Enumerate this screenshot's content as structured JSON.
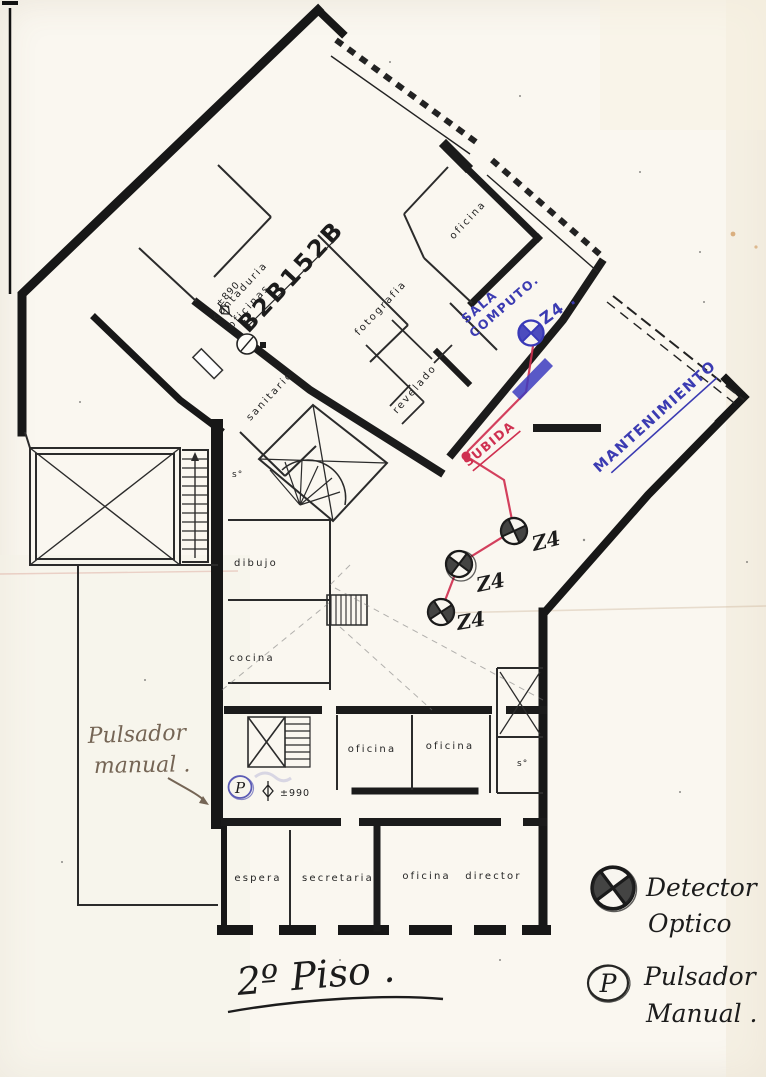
{
  "page": {
    "floor_title": "2º Piso .",
    "background_color": "#faf7f0"
  },
  "plan": {
    "drawing_number": "B2B152B",
    "room_labels": {
      "oficinas_contaduria_line1": "contaduria",
      "oficinas_contaduria_line2": "oficinas",
      "oficina_top": "oficina",
      "fotografia": "fotografia",
      "sanitario": "sanitario",
      "revelado": "revelado",
      "dibujo": "dibujo",
      "cocina": "cocina",
      "oficina_1": "oficina",
      "oficina_2": "oficina",
      "espera": "espera",
      "secretaria": "secretaria",
      "oficina_director": "oficina director",
      "servicio_1": "s°",
      "servicio_2": "s°"
    },
    "elevation_marker_top": "±890",
    "elevation_marker_bottom": "±990"
  },
  "annotations": {
    "ink_colors": {
      "blue": "#3b3bb2",
      "red": "#cf3050",
      "black": "#1c1c1c",
      "pencil": "#756555"
    },
    "sala_computo_line1": "SALA",
    "sala_computo_line2": "COMPUTO.",
    "zone_top": "Z4 .",
    "mantenimiento": "MANTENIMIENTO",
    "subida": "SUBIDA",
    "zone_1": "Z4",
    "zone_2": "Z4",
    "zone_3": "Z4",
    "pulsador_note_line1": "Pulsador",
    "pulsador_note_line2": "manual .",
    "pulsador_symbol": "P"
  },
  "legend": {
    "detector_label_line1": "Detector",
    "detector_label_line2": "Optico",
    "pulsador_label_line1": "Pulsador",
    "pulsador_label_line2": "Manual .",
    "pulsador_symbol": "P"
  }
}
